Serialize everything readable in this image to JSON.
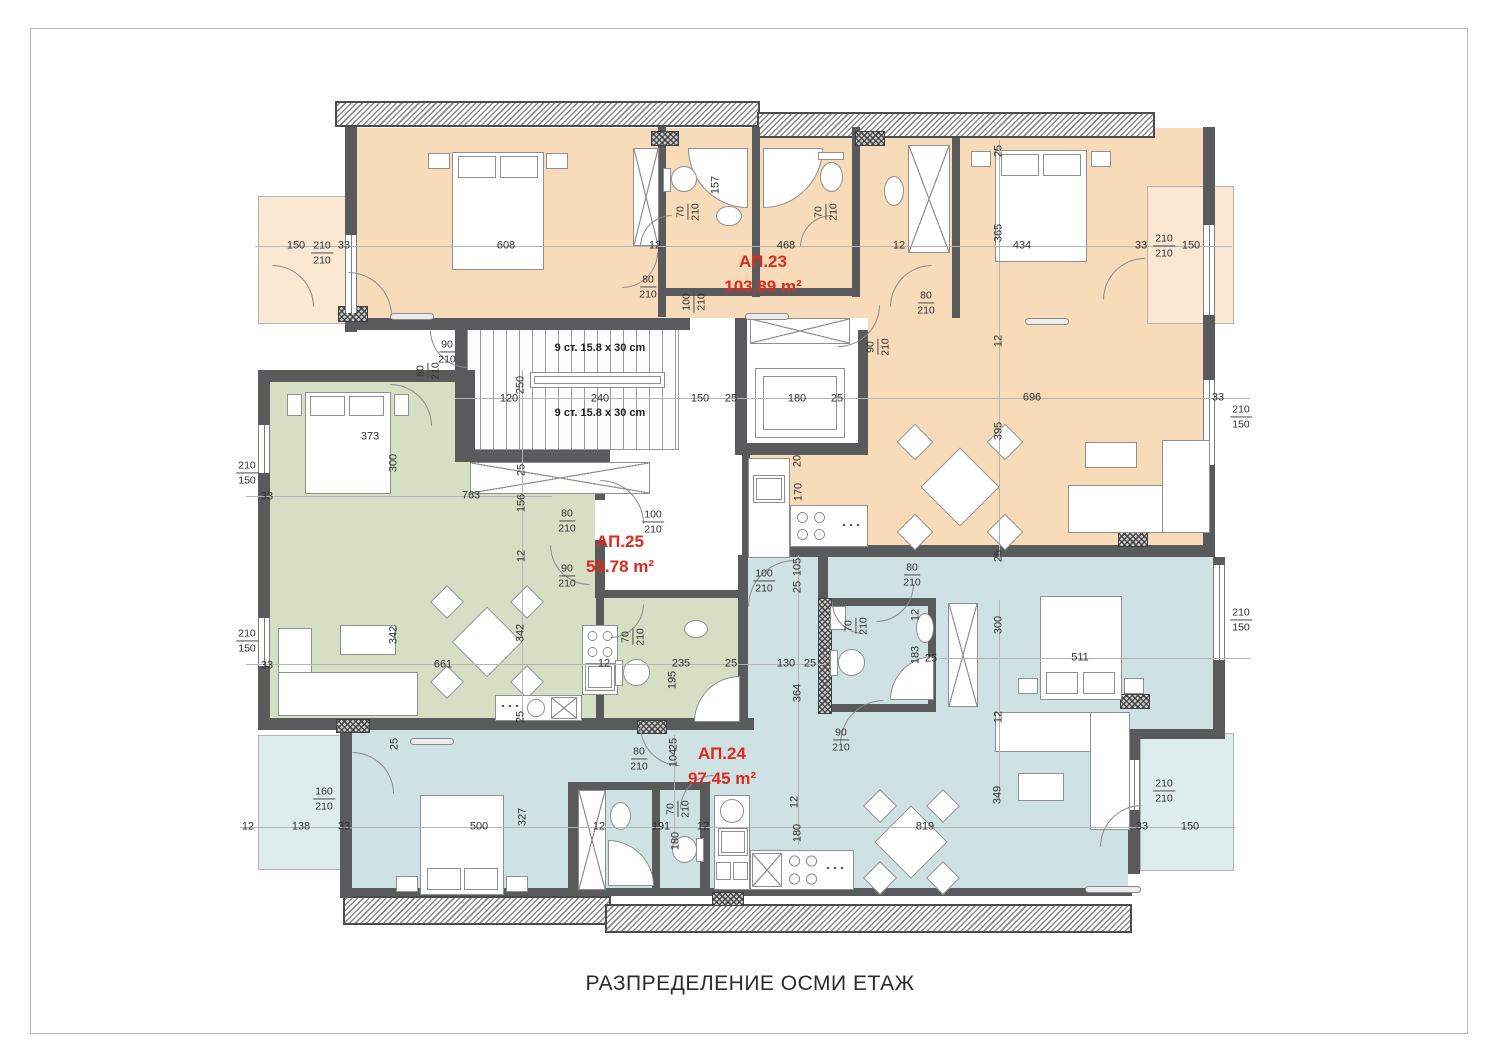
{
  "title": "РАЗПРЕДЕЛЕНИЕ ОСМИ ЕТАЖ",
  "colors": {
    "apartment_label_red": "#e0281e",
    "ap23_fill": "#f8dbb8",
    "ap25_fill": "#d6dfc4",
    "ap24_fill": "#cfe2e3",
    "terrace_orange": "#fae8d2",
    "terrace_blue": "#dfecec",
    "wall_gray": "#595a5c"
  },
  "apartments": [
    {
      "label": "АП.23",
      "area": "103.89 m²",
      "color": "#f8dbb8"
    },
    {
      "label": "АП.25",
      "area": "55.78 m²",
      "color": "#d6dfc4"
    },
    {
      "label": "АП.24",
      "area": "97.45 m²",
      "color": "#cfe2e3"
    }
  ],
  "stairs": {
    "label_top": "9 ст. 15.8 x 30 cm",
    "label_bottom": "9 ст. 15.8 x 30 cm"
  },
  "dimensions": [
    {
      "t": "150",
      "x": 296,
      "y": 246
    },
    {
      "t": "210",
      "b": "210",
      "x": 322,
      "y": 253
    },
    {
      "t": "33",
      "x": 344,
      "y": 246
    },
    {
      "t": "608",
      "x": 506,
      "y": 246
    },
    {
      "t": "12",
      "x": 655,
      "y": 246
    },
    {
      "t": "468",
      "x": 786,
      "y": 246
    },
    {
      "t": "12",
      "x": 899,
      "y": 246
    },
    {
      "t": "25",
      "x": 999,
      "y": 151,
      "r": 1
    },
    {
      "t": "365",
      "x": 999,
      "y": 233,
      "r": 1
    },
    {
      "t": "434",
      "x": 1022,
      "y": 246
    },
    {
      "t": "33",
      "x": 1141,
      "y": 246
    },
    {
      "t": "210",
      "b": "210",
      "x": 1164,
      "y": 246
    },
    {
      "t": "150",
      "x": 1191,
      "y": 246
    },
    {
      "t": "157",
      "x": 716,
      "y": 185,
      "r": 1
    },
    {
      "t": "70",
      "b": "210",
      "x": 688,
      "y": 212,
      "r": 1
    },
    {
      "t": "70",
      "b": "210",
      "x": 826,
      "y": 212,
      "r": 1
    },
    {
      "t": "80",
      "b": "210",
      "x": 648,
      "y": 287
    },
    {
      "t": "100",
      "b": "210",
      "x": 694,
      "y": 302,
      "r": 1
    },
    {
      "t": "80",
      "b": "210",
      "x": 926,
      "y": 303
    },
    {
      "t": "90",
      "b": "210",
      "x": 878,
      "y": 347,
      "r": 1
    },
    {
      "t": "12",
      "x": 999,
      "y": 341,
      "r": 1
    },
    {
      "t": "696",
      "x": 1032,
      "y": 398
    },
    {
      "t": "33",
      "x": 1218,
      "y": 398
    },
    {
      "t": "210",
      "b": "150",
      "x": 1241,
      "y": 417
    },
    {
      "t": "395",
      "x": 999,
      "y": 431,
      "r": 1
    },
    {
      "t": "25",
      "x": 999,
      "y": 556,
      "r": 1
    },
    {
      "t": "90",
      "b": "210",
      "x": 447,
      "y": 352
    },
    {
      "t": "80",
      "b": "210",
      "x": 428,
      "y": 371,
      "r": 1
    },
    {
      "t": "250",
      "x": 521,
      "y": 385,
      "r": 1
    },
    {
      "t": "120",
      "x": 509,
      "y": 399
    },
    {
      "t": "240",
      "x": 600,
      "y": 399
    },
    {
      "t": "150",
      "x": 700,
      "y": 399
    },
    {
      "t": "25",
      "x": 731,
      "y": 399
    },
    {
      "t": "180",
      "x": 797,
      "y": 399
    },
    {
      "t": "25",
      "x": 837,
      "y": 399
    },
    {
      "t": "20",
      "x": 798,
      "y": 461,
      "r": 1
    },
    {
      "t": "170",
      "x": 799,
      "y": 492,
      "r": 1
    },
    {
      "t": "210",
      "b": "150",
      "x": 247,
      "y": 473
    },
    {
      "t": "33",
      "x": 267,
      "y": 497
    },
    {
      "t": "373",
      "x": 370,
      "y": 437
    },
    {
      "t": "300",
      "x": 394,
      "y": 463,
      "r": 1
    },
    {
      "t": "763",
      "x": 471,
      "y": 496
    },
    {
      "t": "25",
      "x": 522,
      "y": 470,
      "r": 1
    },
    {
      "t": "156",
      "x": 522,
      "y": 503,
      "r": 1
    },
    {
      "t": "12",
      "x": 522,
      "y": 556,
      "r": 1
    },
    {
      "t": "210",
      "b": "150",
      "x": 247,
      "y": 641
    },
    {
      "t": "33",
      "x": 267,
      "y": 666
    },
    {
      "t": "342",
      "x": 394,
      "y": 635,
      "r": 1
    },
    {
      "t": "342",
      "x": 521,
      "y": 633,
      "r": 1
    },
    {
      "t": "661",
      "x": 443,
      "y": 665
    },
    {
      "t": "25",
      "x": 521,
      "y": 717,
      "r": 1
    },
    {
      "t": "80",
      "b": "210",
      "x": 567,
      "y": 521
    },
    {
      "t": "100",
      "b": "210",
      "x": 653,
      "y": 522
    },
    {
      "t": "90",
      "b": "210",
      "x": 567,
      "y": 576
    },
    {
      "t": "100",
      "b": "210",
      "x": 764,
      "y": 581
    },
    {
      "t": "105",
      "x": 798,
      "y": 567,
      "r": 1
    },
    {
      "t": "25",
      "x": 798,
      "y": 587,
      "r": 1
    },
    {
      "t": "70",
      "b": "210",
      "x": 633,
      "y": 637,
      "r": 1
    },
    {
      "t": "12",
      "x": 604,
      "y": 664
    },
    {
      "t": "235",
      "x": 681,
      "y": 664
    },
    {
      "t": "25",
      "x": 731,
      "y": 664
    },
    {
      "t": "195",
      "x": 673,
      "y": 680,
      "r": 1
    },
    {
      "t": "130",
      "x": 786,
      "y": 664
    },
    {
      "t": "25",
      "x": 810,
      "y": 664
    },
    {
      "t": "364",
      "x": 798,
      "y": 693,
      "r": 1
    },
    {
      "t": "80",
      "b": "210",
      "x": 912,
      "y": 575
    },
    {
      "t": "70",
      "b": "210",
      "x": 856,
      "y": 626,
      "r": 1
    },
    {
      "t": "12",
      "x": 916,
      "y": 615,
      "r": 1
    },
    {
      "t": "183",
      "x": 916,
      "y": 655,
      "r": 1
    },
    {
      "t": "25",
      "x": 931,
      "y": 659
    },
    {
      "t": "300",
      "x": 999,
      "y": 625,
      "r": 1
    },
    {
      "t": "511",
      "x": 1080,
      "y": 658
    },
    {
      "t": "210",
      "b": "150",
      "x": 1241,
      "y": 620
    },
    {
      "t": "12",
      "x": 999,
      "y": 717,
      "r": 1
    },
    {
      "t": "90",
      "b": "210",
      "x": 841,
      "y": 740
    },
    {
      "t": "349",
      "x": 998,
      "y": 795,
      "r": 1
    },
    {
      "t": "210",
      "b": "210",
      "x": 1164,
      "y": 791
    },
    {
      "t": "33",
      "x": 1142,
      "y": 827
    },
    {
      "t": "150",
      "x": 1190,
      "y": 827
    },
    {
      "t": "12",
      "x": 248,
      "y": 827
    },
    {
      "t": "138",
      "x": 301,
      "y": 827
    },
    {
      "t": "33",
      "x": 344,
      "y": 827
    },
    {
      "t": "160",
      "b": "210",
      "x": 324,
      "y": 799
    },
    {
      "t": "25",
      "x": 395,
      "y": 744,
      "r": 1
    },
    {
      "t": "500",
      "x": 479,
      "y": 827
    },
    {
      "t": "327",
      "x": 523,
      "y": 817,
      "r": 1
    },
    {
      "t": "12",
      "x": 599,
      "y": 827
    },
    {
      "t": "191",
      "x": 661,
      "y": 827
    },
    {
      "t": "12",
      "x": 703,
      "y": 827
    },
    {
      "t": "180",
      "x": 676,
      "y": 841,
      "r": 1
    },
    {
      "t": "104",
      "x": 674,
      "y": 758,
      "r": 1
    },
    {
      "t": "25",
      "x": 674,
      "y": 744,
      "r": 1
    },
    {
      "t": "70",
      "b": "210",
      "x": 678,
      "y": 809,
      "r": 1
    },
    {
      "t": "80",
      "b": "210",
      "x": 639,
      "y": 759
    },
    {
      "t": "12",
      "x": 795,
      "y": 802,
      "r": 1
    },
    {
      "t": "180",
      "x": 798,
      "y": 833,
      "r": 1
    },
    {
      "t": "819",
      "x": 925,
      "y": 827
    }
  ]
}
